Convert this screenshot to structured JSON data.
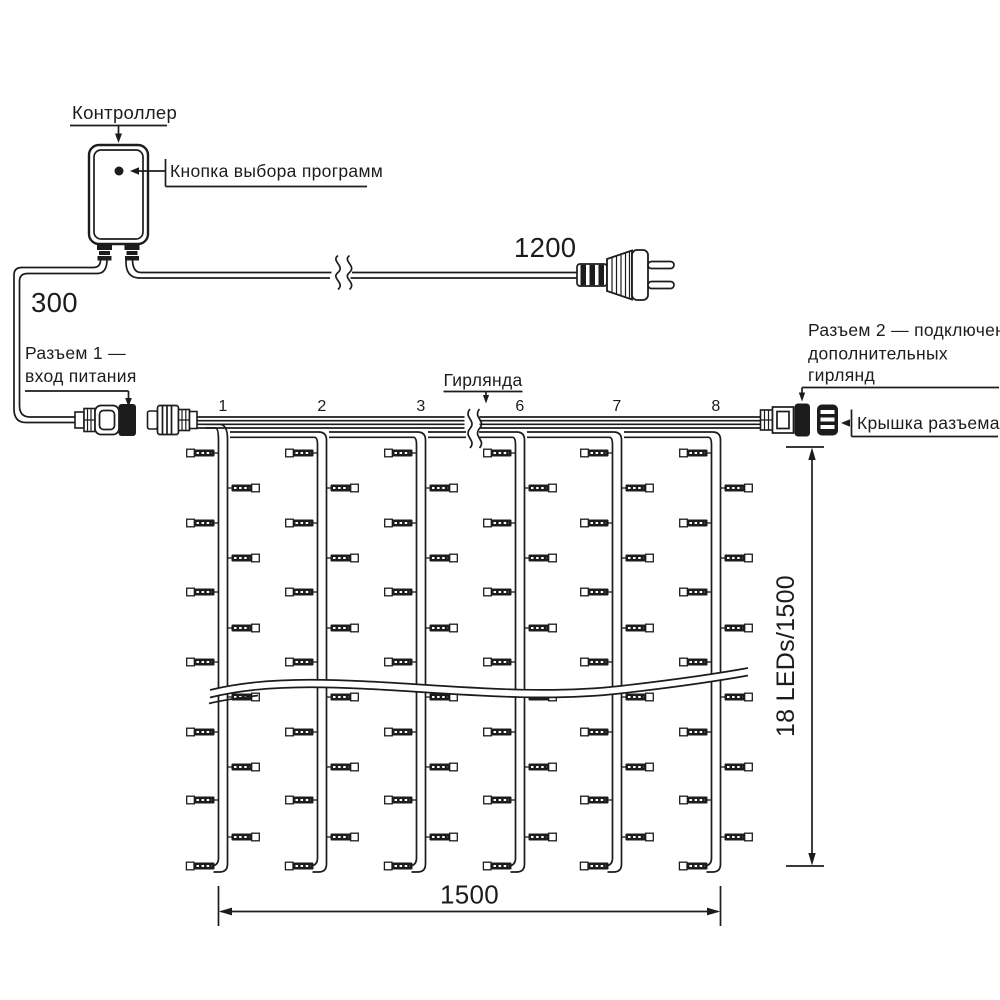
{
  "colors": {
    "line": "#1c1c1c",
    "background": "#ffffff"
  },
  "controller": {
    "label": "Контроллер",
    "button_label": "Кнопка выбора программ"
  },
  "power": {
    "cable_to_controller_length": "300",
    "cable_to_plug_length": "1200"
  },
  "connectors": {
    "connector1_line1": "Разъем 1 —",
    "connector1_line2": "вход питания",
    "connector2_line1": "Разъем 2 — подключение",
    "connector2_line2": "дополнительных",
    "connector2_line3": "гирлянд",
    "cap_label": "Крышка разъема"
  },
  "curtain": {
    "garland_label": "Гирлянда",
    "drop_numbers": [
      "1",
      "2",
      "3",
      "6",
      "7",
      "8"
    ],
    "height_label": "18 LEDs/1500",
    "width_label": "1500"
  }
}
